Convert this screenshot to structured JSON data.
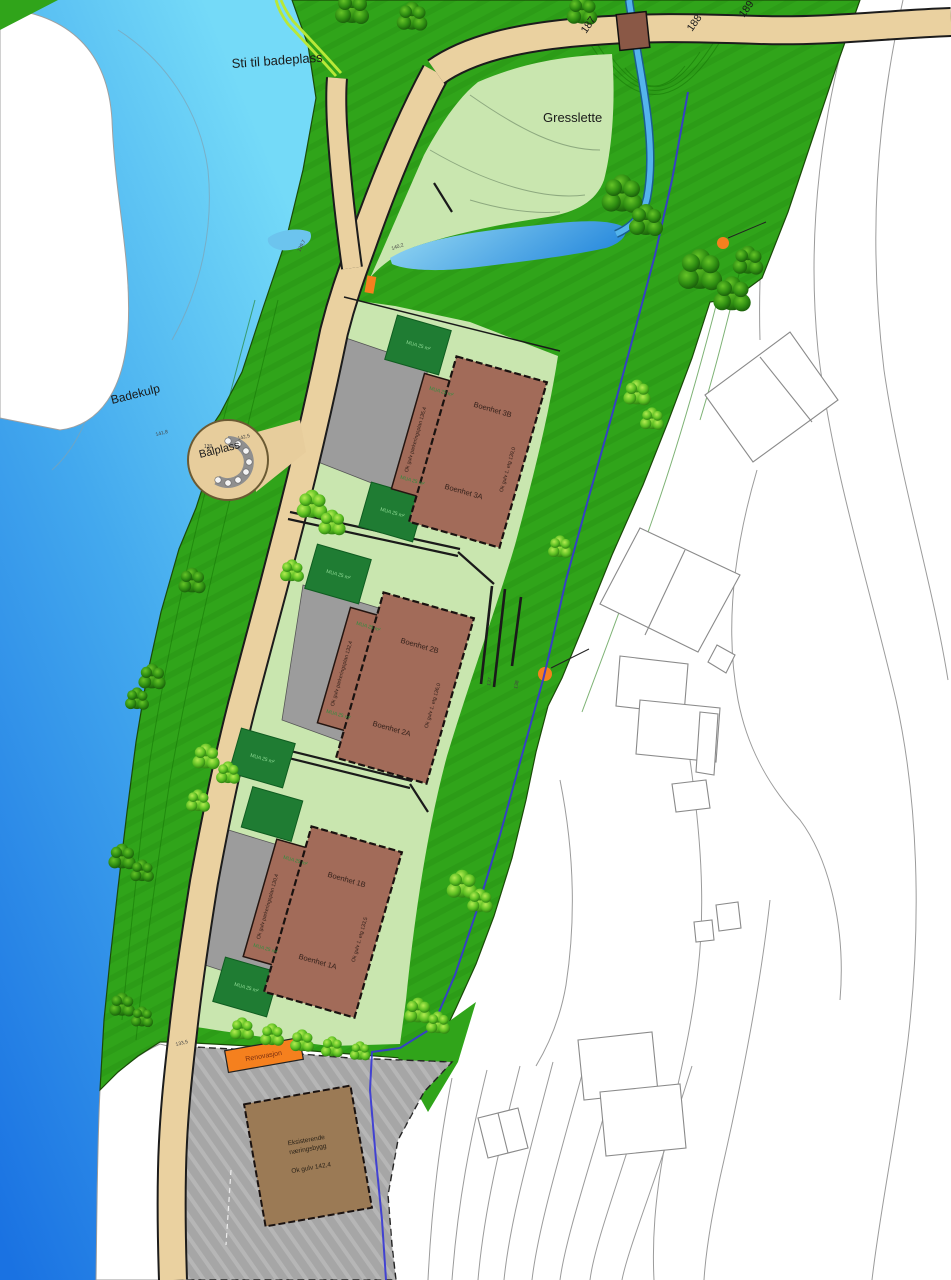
{
  "map_type": "site-plan",
  "labels": {
    "sti_til_badeplass": "Sti til badeplass",
    "gresslette": "Gresslette",
    "badekulp": "Badekulp",
    "badekulp_elevation": "141,8",
    "balplass": "Bålplass",
    "balplass_elevation": "142,5",
    "balplass_inner_elevation": "139",
    "road_contour_187": "187",
    "road_contour_188": "188",
    "road_contour_189": "189",
    "road_elevation_upper": "139,7",
    "road_elevation_mid": "140,2",
    "road_elevation_lower": "133,5",
    "contour_137": "137",
    "contour_138": "138",
    "renovasjon": "Renovasjon"
  },
  "clusters": [
    {
      "unit_b": "Boenhet 3B",
      "unit_a": "Boenhet 3A",
      "floor_level": "Ok gulv 1. etg 139,0",
      "parking_level": "Ok gulv parkeringsplan 135,4",
      "mua_label": "MUA 25 m²"
    },
    {
      "unit_b": "Boenhet 2B",
      "unit_a": "Boenhet 2A",
      "floor_level": "Ok gulv 1. etg 136,0",
      "parking_level": "Ok gulv parkeringsplan 132,4",
      "mua_label": "MUA 25 m²"
    },
    {
      "unit_b": "Boenhet 1B",
      "unit_a": "Boenhet 1A",
      "floor_level": "Ok gulv 1. etg 133,5",
      "parking_level": "Ok gulv parkeringsplan 130,4",
      "mua_label": "MUA 25 m²"
    }
  ],
  "existing_building": {
    "name_line1": "Eksisterende",
    "name_line2": "næringsbygg",
    "floor_level": "Ok gulv 142,4"
  },
  "colors": {
    "water_top": "#74daf8",
    "water_deep": "#1a72e2",
    "green_main": "#30a41a",
    "green_pale": "#c9e6af",
    "mua_square": "#1f7c33",
    "road_tan": "#ead1a0",
    "building_brown": "#a26b59",
    "existing_brown": "#9b7a55",
    "bridge_brown": "#8a5846",
    "gray_parking": "#a6a6a6",
    "orange_marker": "#f5801e",
    "boundary_blue": "#3636d6",
    "pond_blue": "#54b4ec",
    "white_area": "#ffffff"
  }
}
